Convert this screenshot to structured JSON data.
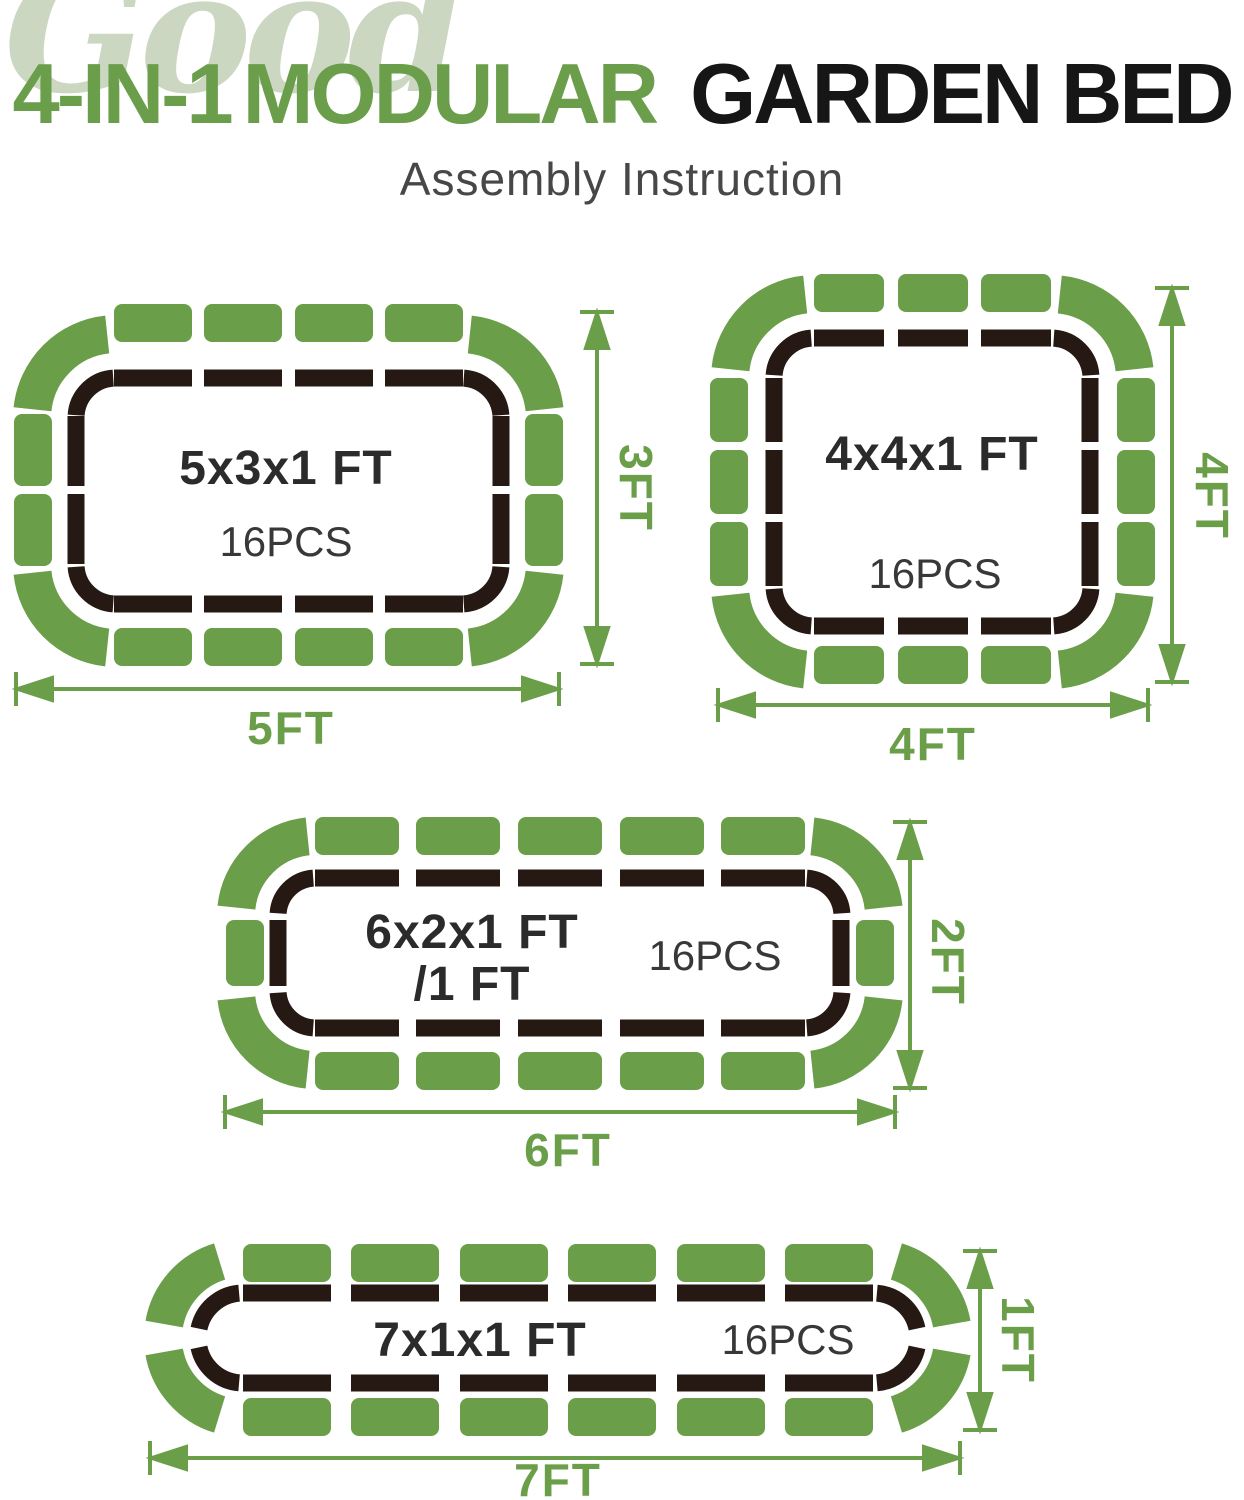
{
  "header": {
    "watermark": "Good",
    "title_green_1": "4-IN-1",
    "title_green_2": "MODULAR",
    "title_black": "GARDEN BED",
    "subtitle": "Assembly Instruction"
  },
  "colors": {
    "panel_green": "#6a9e49",
    "title_green": "#6b9e4b",
    "watermark_green": "#ccd7c1",
    "liner_dark": "#261812",
    "title_black": "#161616",
    "subtitle_gray": "#474747"
  },
  "diagrams": [
    {
      "id": "bed-5x3",
      "size_label": "5x3x1 FT",
      "pieces_label": "16PCS",
      "width_label": "5FT",
      "height_label": "3FT"
    },
    {
      "id": "bed-4x4",
      "size_label": "4x4x1 FT",
      "pieces_label": "16PCS",
      "width_label": "4FT",
      "height_label": "4FT"
    },
    {
      "id": "bed-6x2",
      "size_label": "6x2x1 FT",
      "size_label_line2": "/1 FT",
      "pieces_label": "16PCS",
      "width_label": "6FT",
      "height_label": "2FT"
    },
    {
      "id": "bed-7x1",
      "size_label": "7x1x1 FT",
      "pieces_label": "16PCS",
      "width_label": "7FT",
      "height_label": "1FT"
    }
  ]
}
